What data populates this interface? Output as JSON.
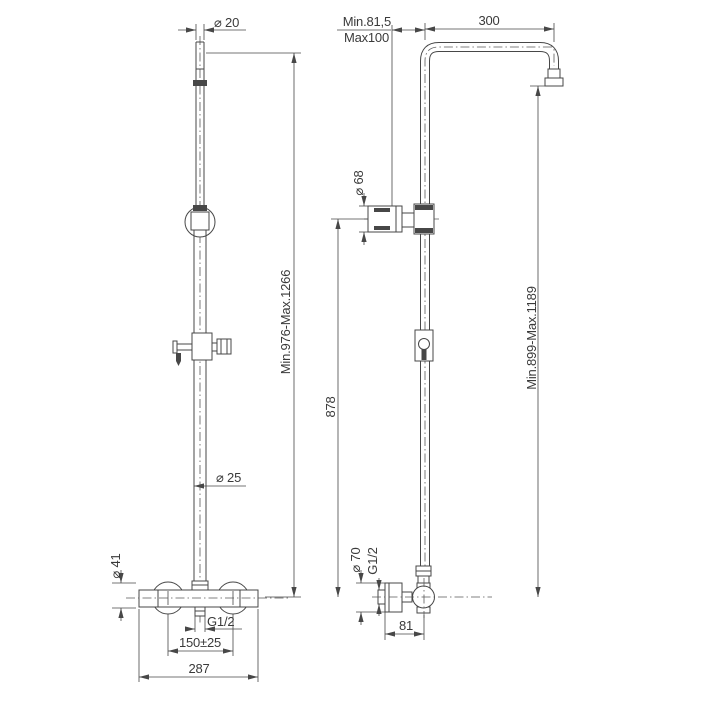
{
  "drawing": {
    "kind": "shower-column-dimension-drawing",
    "background": "#ffffff",
    "line_color": "#474747",
    "text_color": "#3a3a3a"
  },
  "front_view": {
    "name": "front view",
    "dims": {
      "top_pipe_diameter": "⌀ 20",
      "overall_height": "Min.976-Max.1266",
      "rail_diameter": "⌀ 25",
      "valve_body_diameter": "⌀ 41",
      "outlet_thread": "G1/2",
      "inlet_spacing": "150±25",
      "overall_width": "287"
    }
  },
  "side_view": {
    "name": "side view",
    "dims": {
      "wall_distance_min": "Min.81,5",
      "wall_distance_max": "Max100",
      "arm_reach": "300",
      "holder_diameter": "⌀ 68",
      "rail_height": "878",
      "head_height": "Min.899-Max.1189",
      "flange_diameter": "⌀ 70",
      "inlet_thread": "G1/2",
      "valve_wall_offset": "81"
    }
  }
}
